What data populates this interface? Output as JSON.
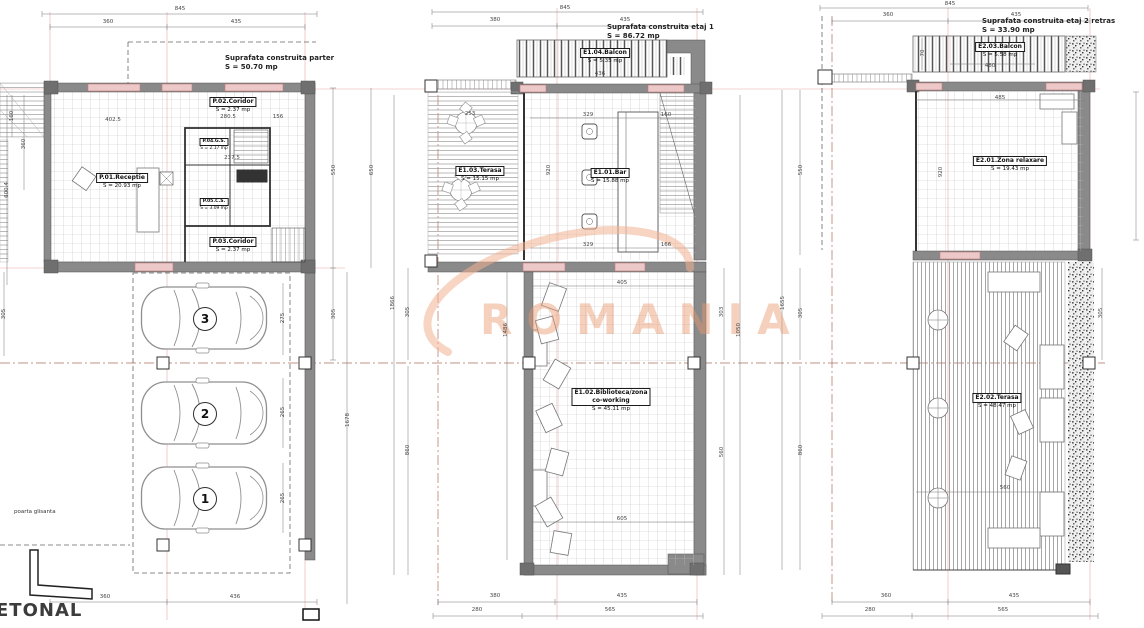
{
  "watermark": {
    "text": "ROMANIA"
  },
  "parter": {
    "note_line1": "Suprafata construita parter",
    "note_line2": "S = 50.70 mp",
    "rooms": {
      "receptie_name": "P.01.Receptie",
      "receptie_area": "S = 20.93 mp",
      "coridor1_name": "P.02.Coridor",
      "coridor1_area": "S = 2.37 mp",
      "gs_name": "P.04.G.S.",
      "gs_area": "S = 2.17 mp",
      "cs_name": "P.05.C.S.",
      "cs_area": "S = 3.09 mp",
      "coridor2_name": "P.03.Coridor",
      "coridor2_area": "S = 2.37 mp"
    },
    "parking_numbers": [
      "3",
      "2",
      "1"
    ],
    "gate_label": "poarta glisanta",
    "street_label": "ETONAL",
    "dims": {
      "top_total": "845",
      "top_left": "360",
      "top_right": "435",
      "bottom_left": "360",
      "bottom_right": "436",
      "right_upper": "550",
      "right_mid": "305",
      "right_outer": "650",
      "right_tall": "1678",
      "left_1": "160",
      "left_2": "360",
      "left_3": "600.4",
      "left_4": "305",
      "in_1": "402.5",
      "in_2": "280.5",
      "in_3": "156",
      "in_4": "237.5",
      "park_1": "275",
      "park_2": "265",
      "park_3": "265"
    }
  },
  "etaj1": {
    "note_line1": "Suprafata construita etaj 1",
    "note_line2": "S = 86.72 mp",
    "rooms": {
      "balcon_name": "E1.04.Balcon",
      "balcon_area": "S = 5.35 mp",
      "terasa_name": "E1.03.Terasa",
      "terasa_area": "S = 15.15 mp",
      "bar_name": "E1.01.Bar",
      "bar_area": "S = 15.88 mp",
      "biblio_name1": "E1.02.Biblioteca/zona",
      "biblio_name2": "co-working",
      "biblio_area": "S = 45.11 mp"
    },
    "dims": {
      "top_total": "845",
      "top_left": "380",
      "top_right": "435",
      "bottom_left": "380",
      "bottom_right": "435",
      "bottom2_left": "280",
      "bottom2_right": "565",
      "balcon_w": "436",
      "in_terasa": "253",
      "in_1": "329",
      "in_2": "160",
      "in_3": "329",
      "in_4": "166",
      "in_5": "405",
      "in_6": "605",
      "v_1": "920",
      "v_2": "1486",
      "left_mid": "305",
      "left_low": "860",
      "left_outer": "1866",
      "right_mid": "303",
      "right_low": "560",
      "right_outer": "1050"
    }
  },
  "etaj2": {
    "note_line1": "Suprafata construita etaj 2 retras",
    "note_line2": "S = 33.90 mp",
    "rooms": {
      "balcon_name": "E2.03.Balcon",
      "balcon_area": "S = 5.58 mp",
      "relax_name": "E2.01.Zona relaxare",
      "relax_area": "S = 19.43 mp",
      "terasa_name": "E2.02.Terasa",
      "terasa_area": "S = 48.47 mp"
    },
    "dims": {
      "top_total": "845",
      "top_left": "360",
      "top_right": "435",
      "bottom_left": "360",
      "bottom_right": "435",
      "bottom2_left": "280",
      "bottom2_right": "565",
      "balcon_w": "480",
      "balcon_h": "70",
      "in_1": "485",
      "in_2": "560",
      "v_1": "920",
      "left_upper": "550",
      "left_mid": "305",
      "left_low": "860",
      "left_outer": "1655",
      "right_mid": "305"
    }
  }
}
